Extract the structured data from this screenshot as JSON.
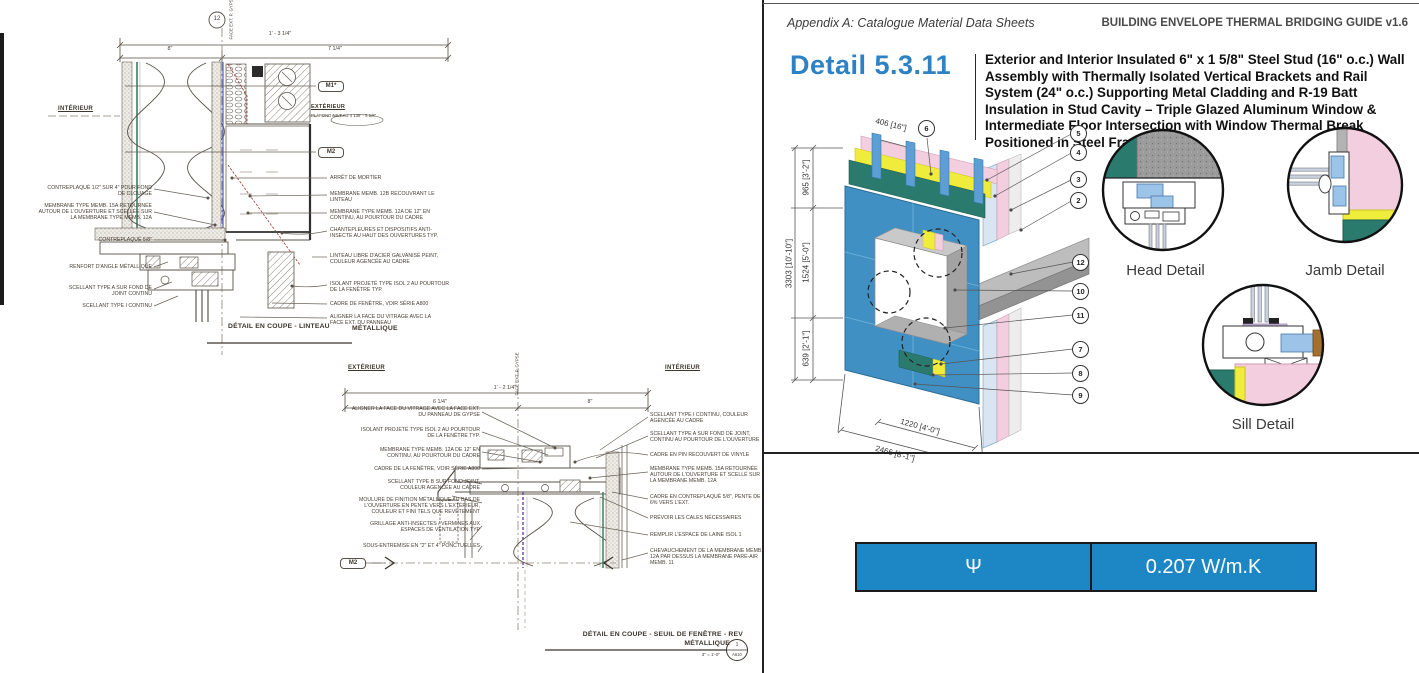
{
  "colors": {
    "accent_blue": "#2e82c4",
    "table_blue": "#1d87c6",
    "cladding_blue": "#4090c4",
    "teal_panel": "#2a7a6e",
    "insulation_yellow": "#f0ec3c",
    "insulation_pink": "#f3cede",
    "slab_gray": "#9a9a9a",
    "wood_brown": "#a5702d"
  },
  "lintel": {
    "bubble": "12",
    "face_ref": "FACE EXT. P. GYPSE",
    "dim_total": "1' - 3 1/4\"",
    "dim_left": "8\"",
    "dim_right": "7 1/4\"",
    "interior": "INTÉRIEUR",
    "exterior": "EXTÉRIEUR",
    "ceiling_prefix": "PLAFOND NIVEAU 4",
    "ceiling_elev": "138' - 5 5/8\"",
    "m1": "M1*",
    "m2": "M2",
    "labels_left": [
      "CONTREPLAQUÉ 1/2\" SUR 4\" POUR FOND DE CLOUAGE",
      "MEMBRANE TYPE MEMB. 15A RETOURNÉE AUTOUR DE L'OUVERTURE ET SCELLÉE SUR LA MEMBRANE TYPE MEMB. 12A",
      "CONTREPLAQUÉ 5/8\"",
      "RENFORT D'ANGLE MÉTALLIQUE",
      "SCELLANT TYPE A SUR FOND DE JOINT CONTINU",
      "SCELLANT TYPE I CONTINU"
    ],
    "labels_right": [
      "ARRÊT DE MORTIER",
      "MEMBRANE MEMB. 12B RECOUVRANT LE LINTEAU",
      "MEMBRANE TYPE MEMB. 12A DE 12\" EN CONTINU, AU POURTOUR DU CADRE",
      "CHANTEPLEURES ET DISPOSITIFS ANTI-INSECTE AU HAUT DES OUVERTURES TYP.",
      "LINTEAU LIBRE D'ACIER GALVANISÉ PEINT, COULEUR AGENCÉE AU CADRE",
      "ISOLANT PROJETÉ TYPE ISOL 2 AU POURTOUR DE LA FENÊTRE TYP.",
      "CADRE DE FENÊTRE, VOIR SÉRIE A800",
      "ALIGNER LA FACE DU VITRAGE AVEC LA FACE EXT. DU PANNEAU"
    ],
    "caption": "DÉTAIL EN COUPE - LINTEAU",
    "caption_overlap": "MÉTALLIQUE"
  },
  "sill": {
    "exterior": "EXTÉRIEUR",
    "interior": "INTÉRIEUR",
    "face_ref": "FACE EXT. P. GYPSE",
    "dim_total": "1' - 2 1/4\"",
    "dim_left": "6 1/4\"",
    "dim_right": "8\"",
    "labels_left": [
      "ALIGNER LA FACE DU VITRAGE AVEC LA FACE EXT. DU PANNEAU DE GYPSE",
      "ISOLANT PROJETÉ TYPE ISOL 2 AU POURTOUR DE LA FENÊTRE TYP.",
      "MEMBRANE TYPE MEMB. 12A DE 12\" EN CONTINU, AU POURTOUR DU CADRE",
      "CADRE DE LA FENÊTRE, VOIR SÉRIE A800",
      "SCELLANT TYPE B SUR FOND JOINT, COULEUR AGENCÉE AU CADRE",
      "MOULURE DE FINITION MÉTALLIQUE AU BAS DE L'OUVERTURE EN PENTE VERS L'EXTÉRIEUR, COULEUR ET FINI TELS QUE REVÊTEMENT",
      "GRILLAGE ANTI-INSECTES / VERMINES AUX ESPACES DE VENTILATION TYP",
      "SOUS-ENTREMISE EN \"2\" ET 4\" PONCTUELLES"
    ],
    "labels_right": [
      "SCELLANT TYPE I CONTINU, COULEUR AGENCÉE AU CADRE",
      "SCELLANT TYPE A SUR FOND DE JOINT, CONTINU AU POURTOUR DE L'OUVERTURE",
      "CADRE EN PIN RECOUVERT DE VINYLE",
      "MEMBRANE TYPE MEMB. 15A RETOURNÉE AUTOUR DE L'OUVERTURE ET SCELLÉ SUR LA MEMBRANE MEMB. 12A",
      "CADRE EN CONTREPLAQUÉ 5/8\", PENTE DE 6% VERS L'EXT.",
      "PRÉVOIR LES CALES NÉCESSAIRES",
      "REMPLIR L'ESPACE DE LAINE ISOL 1",
      "CHEVAUCHEMENT DE LA MEMBRANE MEMB. 12A PAR DESSUS LA MEMBRANE PARE-AIR MEMB. 11"
    ],
    "m2": "M2",
    "caption_line1": "DÉTAIL EN COUPE - SEUIL DE FENÊTRE - REV",
    "caption_line2": "MÉTALLIQUE",
    "scale": "3\" = 1'-0\"",
    "bubble_num": "1",
    "bubble_sheet": "A610"
  },
  "guide": {
    "header_left": "Appendix A: Catalogue Material Data Sheets",
    "header_right": "BUILDING ENVELOPE THERMAL BRIDGING GUIDE v1.6",
    "detail_number": "Detail 5.3.11",
    "detail_title": "Exterior and Interior Insulated 6\" x 1 5/8\" Steel Stud (16\" o.c.) Wall Assembly with Thermally Isolated Vertical Brackets and Rail System (24\" o.c.) Supporting Metal Cladding and R-19 Batt Insulation in Stud Cavity – Triple Glazed Aluminum Window & Intermediate Floor Intersection with Window Thermal Break Positioned in Steel Framing",
    "axon": {
      "dim_stud_spacing": "406 [16\"]",
      "dim_above_window": "965 [3'-2\"]",
      "dim_total_height": "3303 [10'-10\"]",
      "dim_window_height": "1524 [5'-0\"]",
      "dim_below_window": "639 [2'-1\"]",
      "dim_window_width": "1220 [4'-0\"]",
      "dim_total_width": "2466 [8'-1\"]",
      "callout_top": "6",
      "callouts_right": [
        "5",
        "4",
        "3",
        "2",
        "12",
        "10",
        "11",
        "7",
        "8",
        "9"
      ]
    },
    "detail_labels": {
      "head": "Head Detail",
      "jamb": "Jamb Detail",
      "sill": "Sill Detail"
    },
    "psi_symbol": "Ψ",
    "psi_value": "0.207 W/m.K"
  }
}
